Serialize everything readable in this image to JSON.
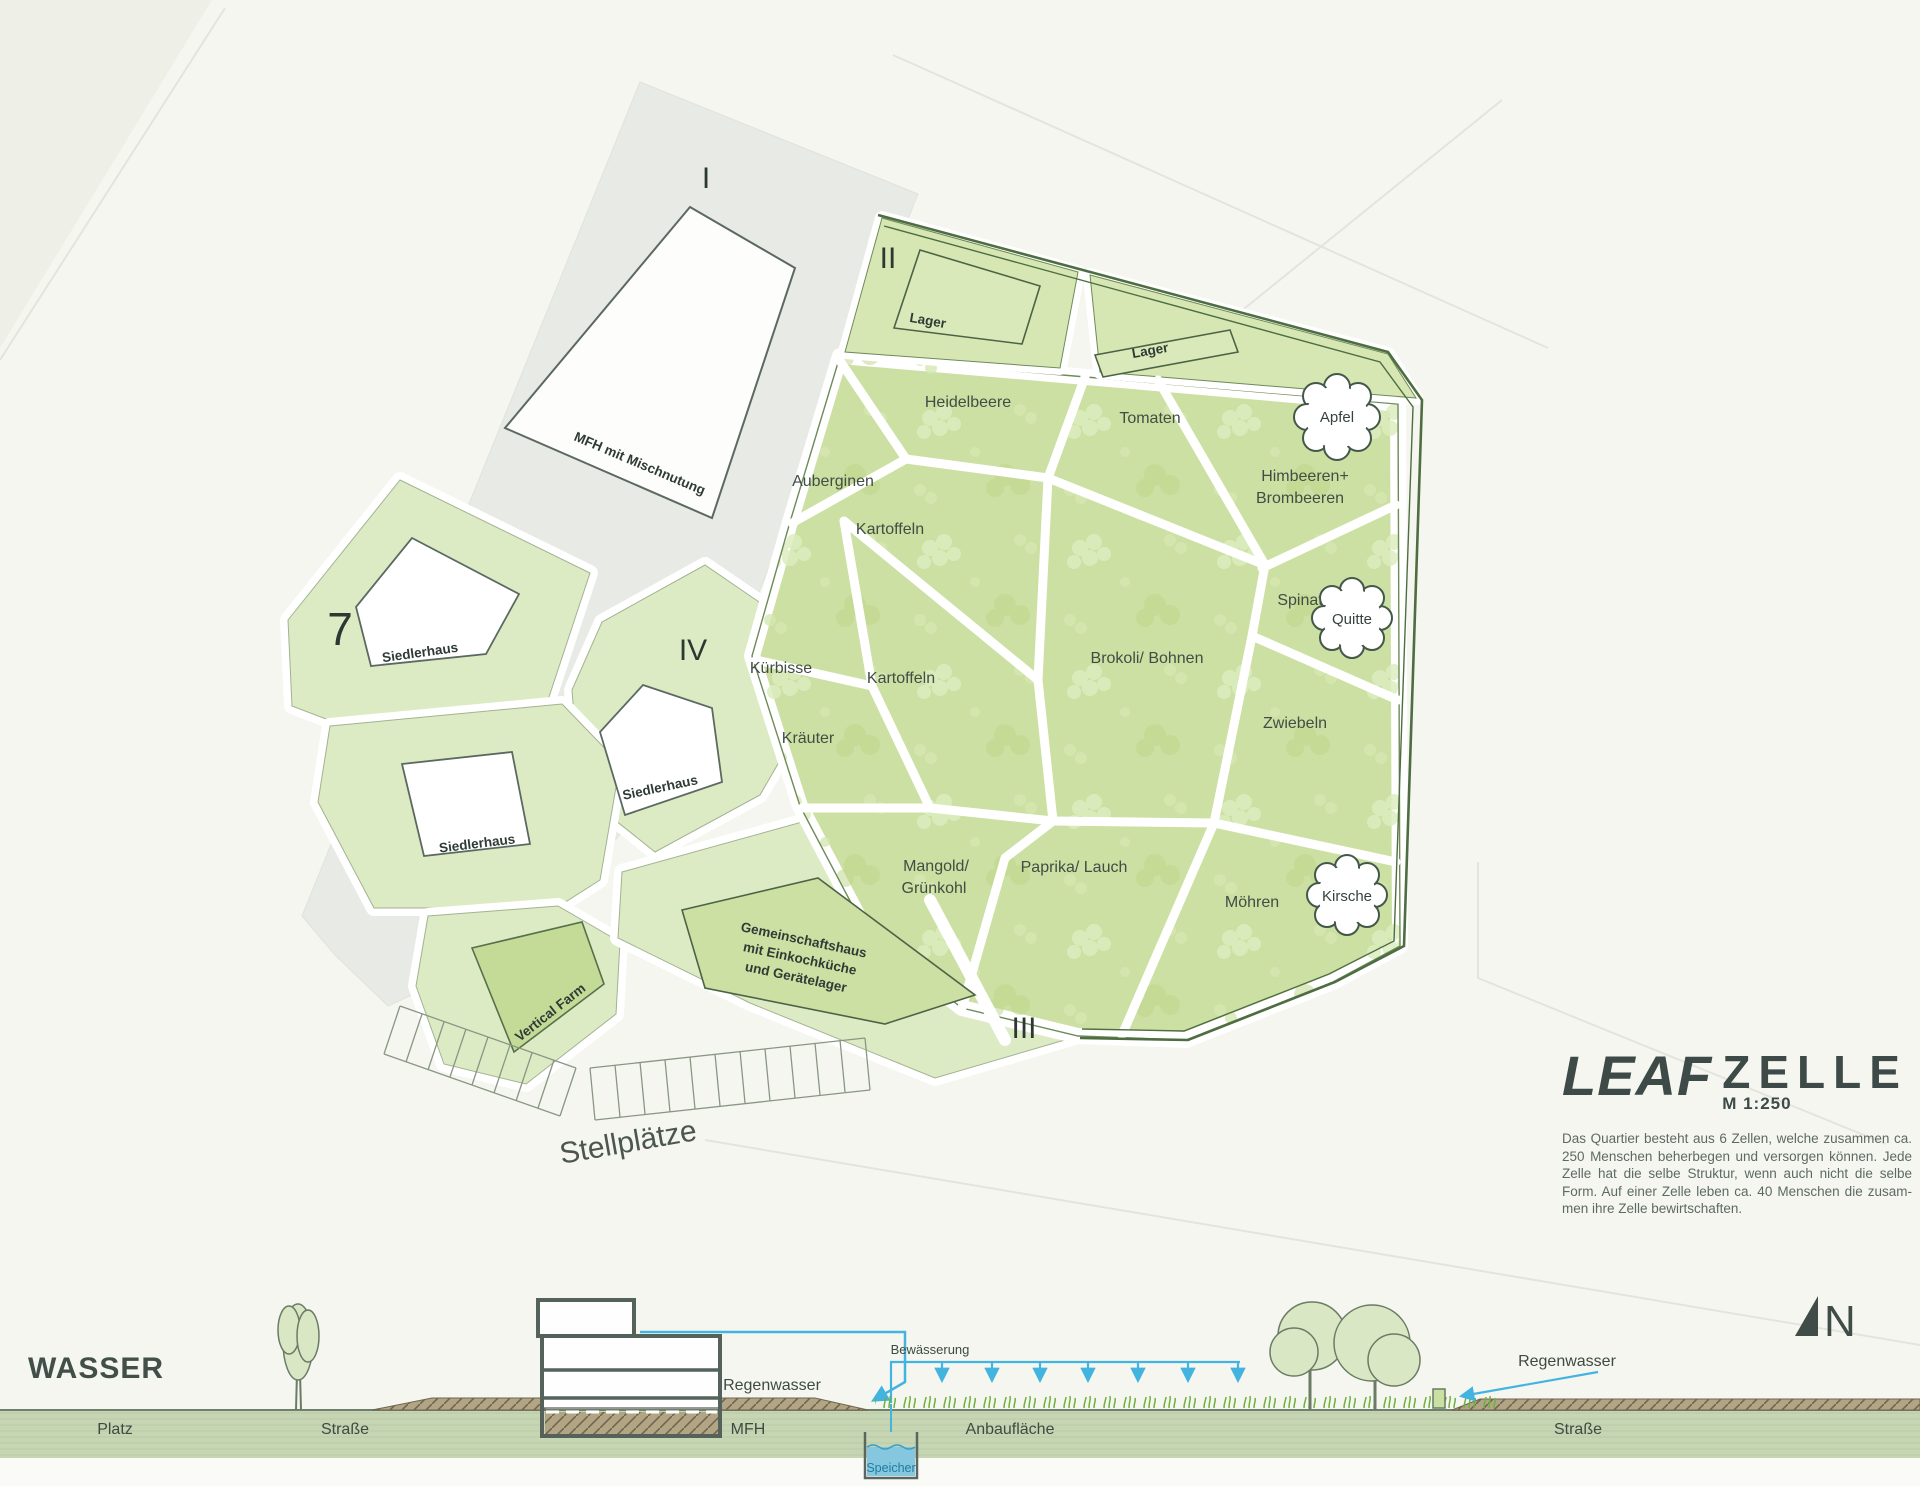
{
  "plan": {
    "zones": {
      "i": "I",
      "ii": "II",
      "iii": "III",
      "iv": "IV",
      "seven": "7"
    },
    "buildings": {
      "mfh": "MFH mit Mischnutung",
      "lager1": "Lager",
      "lager2": "Lager",
      "siedlerhaus1": "Siedlerhaus",
      "siedlerhaus2": "Siedlerhaus",
      "siedlerhaus3": "Siedlerhaus",
      "vertical_farm": "Vertical Farm",
      "gemein1": "Gemeinschaftshaus",
      "gemein2": "mit Einkochküche",
      "gemein3": "und Gerätelager",
      "stellplaetze": "Stellplätze"
    },
    "plots": {
      "heidelbeere": "Heidelbeere",
      "tomaten": "Tomaten",
      "auberginen": "Auberginen",
      "kartoffeln_oben": "Kartoffeln",
      "himbeeren1": "Himbeeren+",
      "himbeeren2": "Brombeeren",
      "spinat": "Spinat",
      "kuerbisse": "Kürbisse",
      "kartoffeln_mitte": "Kartoffeln",
      "brokoli": "Brokoli/ Bohnen",
      "kraeuter": "Kräuter",
      "zwiebeln": "Zwiebeln",
      "mangold1": "Mangold/",
      "mangold2": "Grünkohl",
      "paprika": "Paprika/ Lauch",
      "moehren": "Möhren"
    },
    "trees": {
      "apfel": "Apfel",
      "quitte": "Quitte",
      "kirsche": "Kirsche"
    }
  },
  "title_block": {
    "brand": "LEAF",
    "subtitle": "ZELLE",
    "scale": "M 1:250",
    "description": {
      "line1": "Das Quartier besteht aus 6 Zellen, welche zusammen ca.",
      "line2": "250 Menschen beherbegen und versorgen können. Jede",
      "line3": "Zelle hat die selbe Struktur, wenn auch nicht die selbe",
      "line4": "Form. Auf einer Zelle leben ca. 40 Menschen die zusam-",
      "line5": "men ihre Zelle bewirtschaften."
    }
  },
  "section": {
    "heading": "WASSER",
    "labels": {
      "platz": "Platz",
      "strasse_links": "Straße",
      "mfh": "MFH",
      "anbauflaeche": "Anbaufläche",
      "strasse_rechts": "Straße",
      "regenwasser_links": "Regenwasser",
      "regenwasser_rechts": "Regenwasser",
      "bewaesserung": "Bewässerung",
      "speicher": "Speicher"
    }
  },
  "compass": {
    "north": "N"
  },
  "colors": {
    "accent_cyan": "#43b4e0",
    "garden_green": "#cbe0a2",
    "parcel_green": "#dcebc4",
    "street_gray": "#e8eae5",
    "road_brown": "#b2a584",
    "ink": "#36433c"
  }
}
